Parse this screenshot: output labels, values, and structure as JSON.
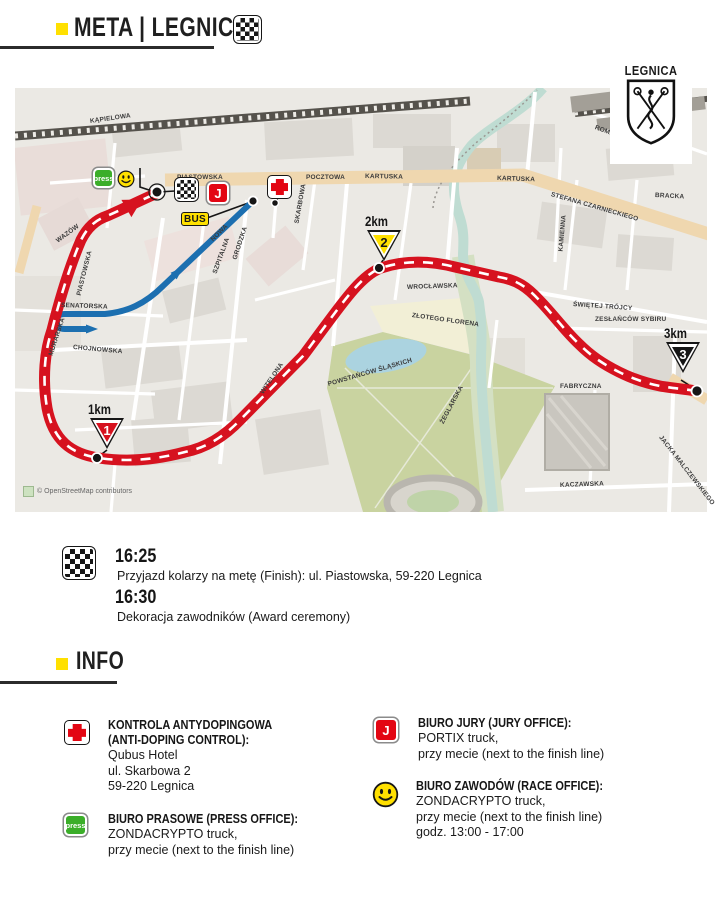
{
  "header": {
    "title": "META | LEGNICA"
  },
  "info_header": {
    "title": "INFO"
  },
  "colors": {
    "accent_yellow": "#FFE000",
    "route_red": "#D6121F",
    "route_blue": "#1C6FB0",
    "press_green": "#3BAE29",
    "cross_red": "#E30613",
    "marker_1km": "#D6121F",
    "marker_2km": "#FFE000",
    "marker_3km": "#161616"
  },
  "badges": {
    "press": "press",
    "jury": "J",
    "bus": "BUS"
  },
  "map": {
    "city_label": "LEGNICA",
    "attribution": "© OpenStreetMap contributors",
    "km_markers": [
      {
        "label": "1km",
        "value": "1"
      },
      {
        "label": "2km",
        "value": "2"
      },
      {
        "label": "3km",
        "value": "3"
      }
    ],
    "streets": [
      {
        "name": "KĄPIELOWA"
      },
      {
        "name": "DWORCOWA"
      },
      {
        "name": "PIASTOWSKA"
      },
      {
        "name": "POCZTOWA"
      },
      {
        "name": "KARTUSKA"
      },
      {
        "name": "STEFANA CZARNIECKIEGO"
      },
      {
        "name": "ROMANA DMOWSKIEGO"
      },
      {
        "name": "KAMIENNA"
      },
      {
        "name": "WROCŁAWSKA"
      },
      {
        "name": "ŚWIĘTEJ TRÓJCY"
      },
      {
        "name": "ZESŁAŃCÓW SYBIRU"
      },
      {
        "name": "WITELONA"
      },
      {
        "name": "POWSTAŃCÓW ŚLĄSKICH"
      },
      {
        "name": "SENATORSKA"
      },
      {
        "name": "CHOJNOWSKA"
      },
      {
        "name": "NOWA"
      },
      {
        "name": "GRODZKA"
      },
      {
        "name": "SZPITALNA"
      },
      {
        "name": "SKARBOWA"
      },
      {
        "name": "PIASTOWSKA"
      },
      {
        "name": "WAZÓW"
      },
      {
        "name": "FABRYCZNA"
      },
      {
        "name": "KACZAWSKA"
      },
      {
        "name": "JACKA MALCZEWSKIEGO"
      },
      {
        "name": "MURARSKA"
      },
      {
        "name": "ZŁOTEGO FLORENA"
      },
      {
        "name": "BRACKA"
      },
      {
        "name": "ŻEGLARSKA"
      },
      {
        "name": "KARTUSKA"
      }
    ]
  },
  "schedule": {
    "rows": [
      {
        "time": "16:25",
        "desc": "Przyjazd kolarzy na metę (Finish): ul. Piastowska, 59-220 Legnica"
      },
      {
        "time": "16:30",
        "desc": "Dekoracja zawodników (Award ceremony)"
      }
    ]
  },
  "info": {
    "left": [
      {
        "title1": "KONTROLA ANTYDOPINGOWA",
        "title2": "(ANTI-DOPING CONTROL):",
        "line1": "Qubus Hotel",
        "line2": "ul. Skarbowa 2",
        "line3": "59-220 Legnica"
      },
      {
        "title1": "BIURO PRASOWE (PRESS OFFICE):",
        "line1": "ZONDACRYPTO truck,",
        "line2": "przy mecie (next to the finish line)"
      }
    ],
    "right": [
      {
        "title1": "BIURO JURY (JURY OFFICE):",
        "line1": "PORTIX truck,",
        "line2": "przy mecie (next to the finish line)"
      },
      {
        "title1": "BIURO ZAWODÓW (RACE OFFICE):",
        "line1": "ZONDACRYPTO truck,",
        "line2": "przy mecie (next to the finish line)",
        "line3": "godz. 13:00 - 17:00"
      }
    ]
  }
}
